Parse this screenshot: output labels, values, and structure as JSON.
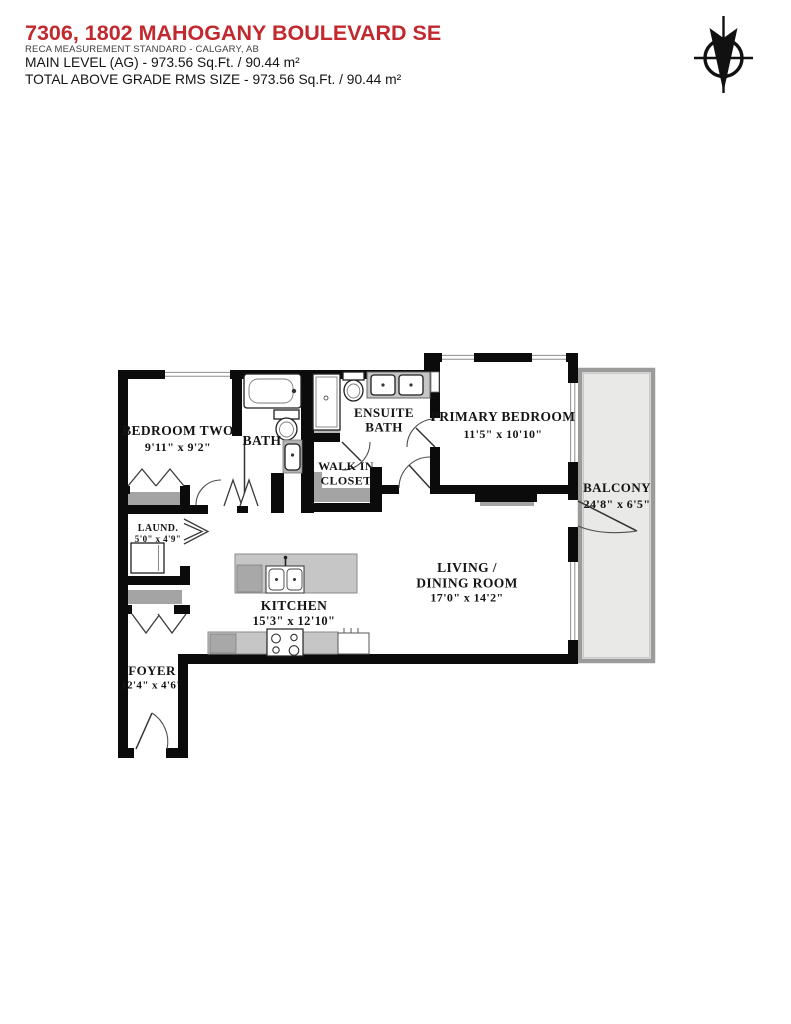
{
  "header": {
    "title": "7306, 1802 MAHOGANY BOULEVARD SE",
    "subtitle": "RECA MEASUREMENT STANDARD - CALGARY, AB",
    "level_line": "MAIN LEVEL (AG) - 973.56 Sq.Ft. / 90.44 m²",
    "total_line": "TOTAL ABOVE GRADE RMS SIZE - 973.56 Sq.Ft. / 90.44 m²"
  },
  "colors": {
    "title_red": "#c2292e",
    "wall_black": "#0b0b0b",
    "balcony_fill": "#e9e9e7",
    "balcony_border": "#9b9b9b",
    "counter_gray": "#c6c6c6",
    "shelf_gray": "#a4a4a4"
  },
  "compass": {
    "icon": "north-arrow-compass"
  },
  "rooms": {
    "bedroom_two": {
      "name": "BEDROOM TWO",
      "dims": "9'11\" x 9'2\""
    },
    "bath": {
      "name": "BATH"
    },
    "ensuite_bath": {
      "line1": "ENSUITE",
      "line2": "BATH"
    },
    "walk_in_closet": {
      "line1": "WALK IN",
      "line2": "CLOSET"
    },
    "primary_bedroom": {
      "name": "PRIMARY BEDROOM",
      "dims": "11'5\" x 10'10\""
    },
    "balcony": {
      "name": "BALCONY",
      "dims": "24'8\" x 6'5\""
    },
    "laundry": {
      "name": "LAUND.",
      "dims": "5'0\" x 4'9\""
    },
    "kitchen": {
      "name": "KITCHEN",
      "dims": "15'3\" x 12'10\""
    },
    "living_dining": {
      "line1": "LIVING /",
      "line2": "DINING ROOM",
      "dims": "17'0\" x 14'2\""
    },
    "foyer": {
      "name": "FOYER",
      "dims": "12'4\" x 4'6\""
    }
  }
}
